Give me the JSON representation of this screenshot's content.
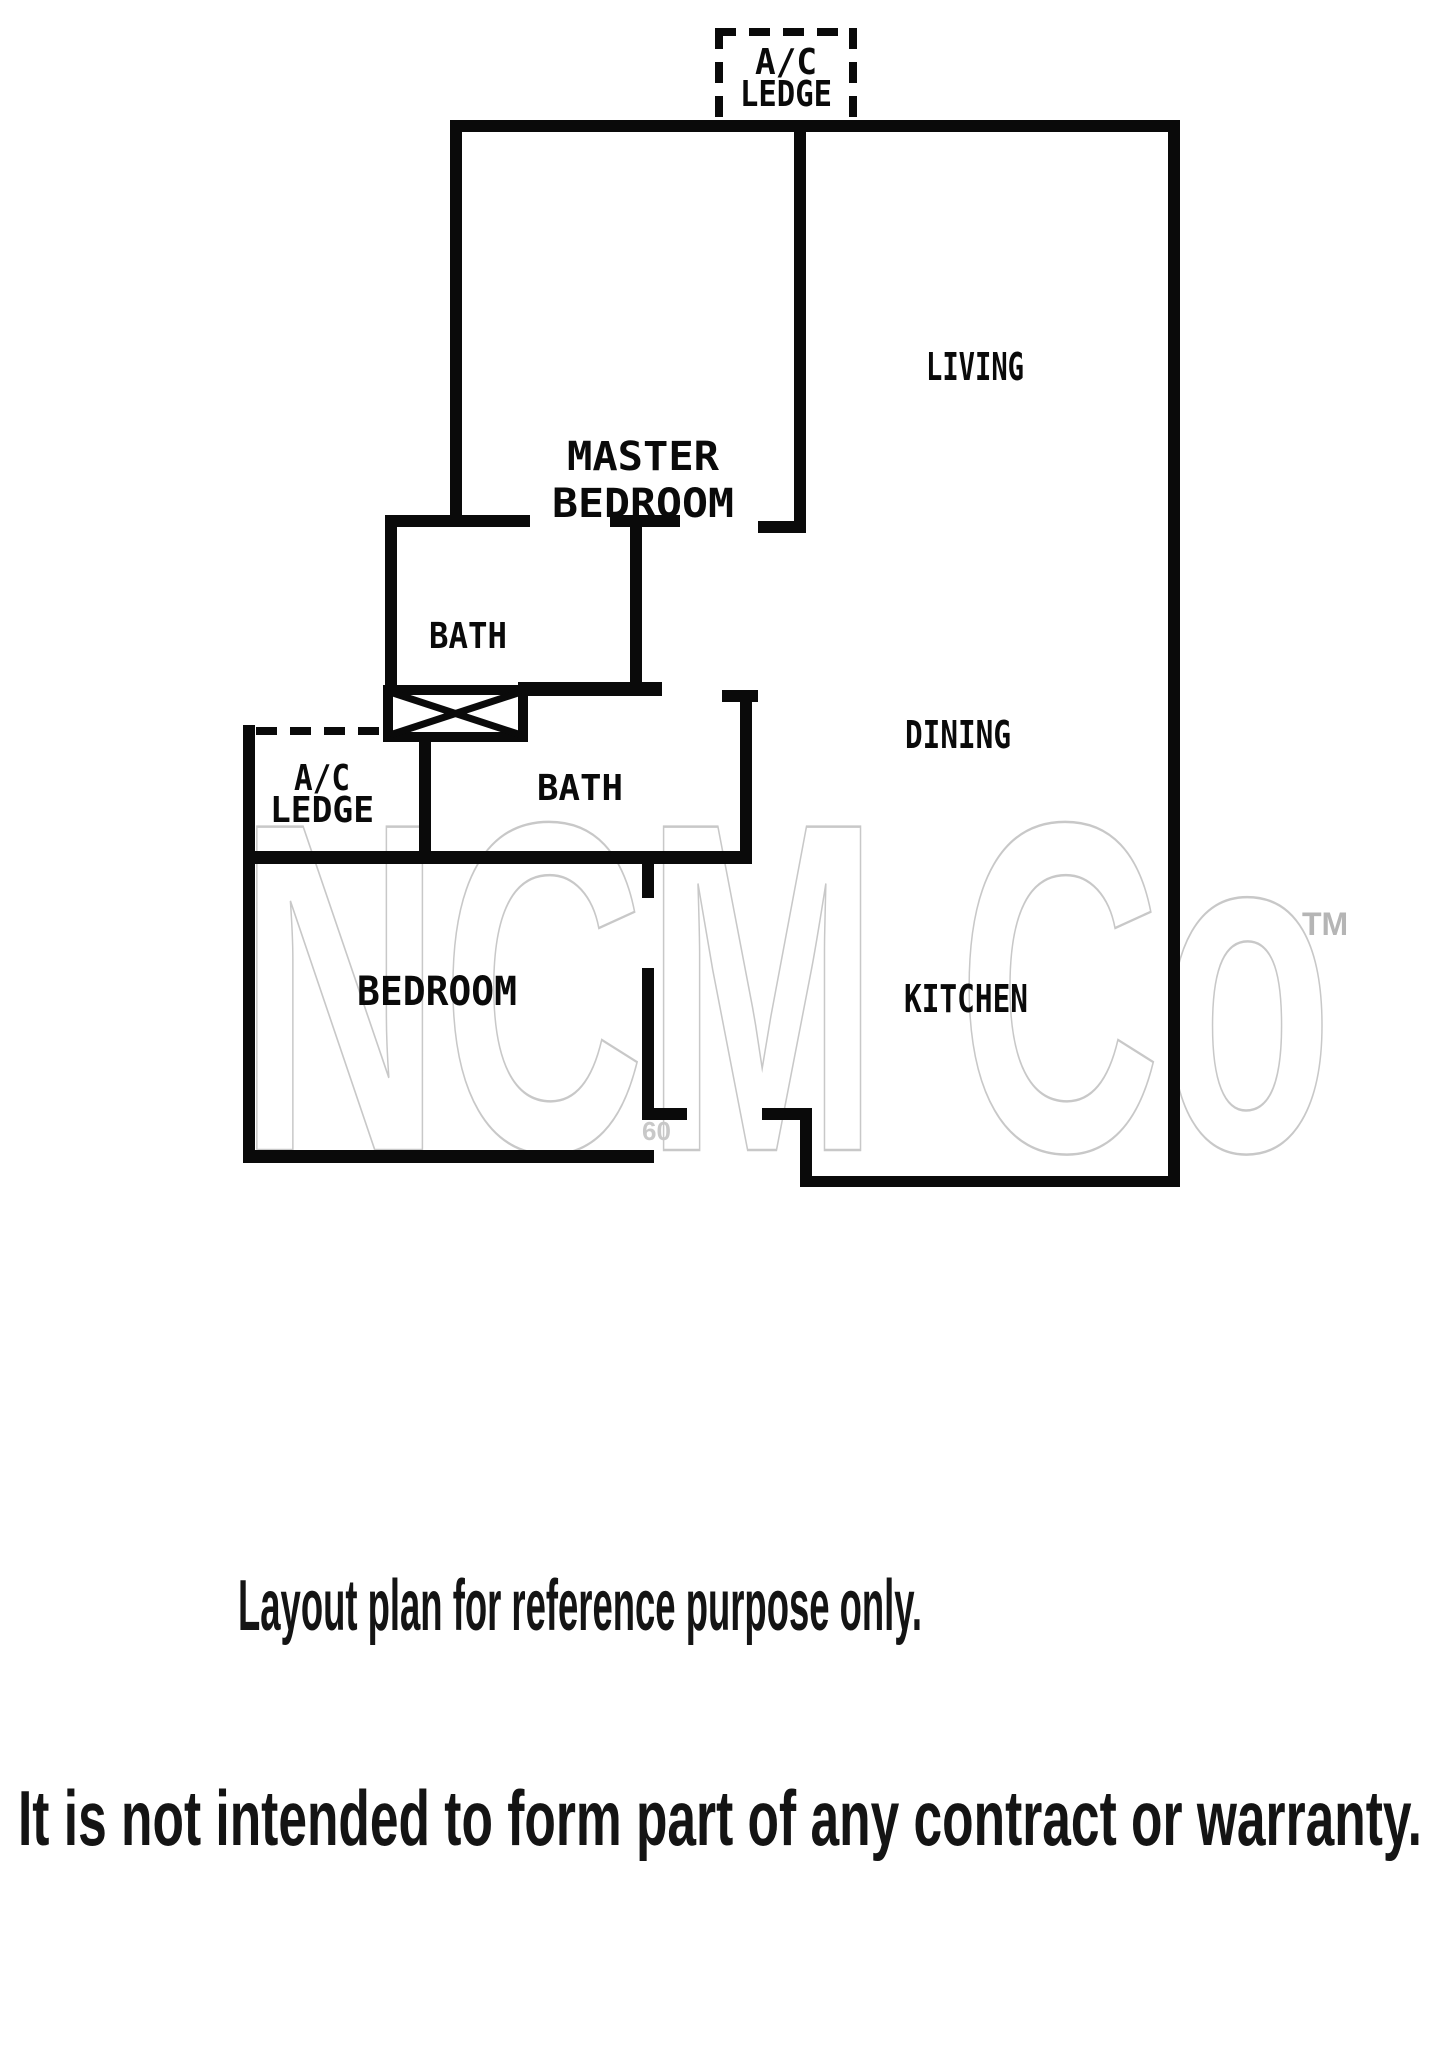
{
  "plan": {
    "ac_ledge_top": {
      "line1": "A/C",
      "line2": "LEDGE"
    },
    "master_bedroom": {
      "line1": "MASTER",
      "line2": "BEDROOM"
    },
    "living": {
      "label": "LIVING"
    },
    "dining": {
      "label": "DINING"
    },
    "bath_upper": {
      "label": "BATH"
    },
    "bath_lower": {
      "label": "BATH"
    },
    "ac_ledge_left": {
      "line1": "A/C",
      "line2": "LEDGE"
    },
    "bedroom": {
      "label": "BEDROOM"
    },
    "kitchen": {
      "label": "KITCHEN"
    }
  },
  "watermark": {
    "brand": "NCM Co",
    "trademark": "TM",
    "stray_digits": "60"
  },
  "captions": {
    "reference": "Layout plan for reference purpose only.",
    "warranty": "It is not intended to form part of any contract or warranty."
  },
  "colors": {
    "wall": "#0a0a0a",
    "background": "#ffffff",
    "watermark": "#c8c8c8",
    "watermark_tm": "#b5b5b5",
    "caption": "#141414"
  }
}
